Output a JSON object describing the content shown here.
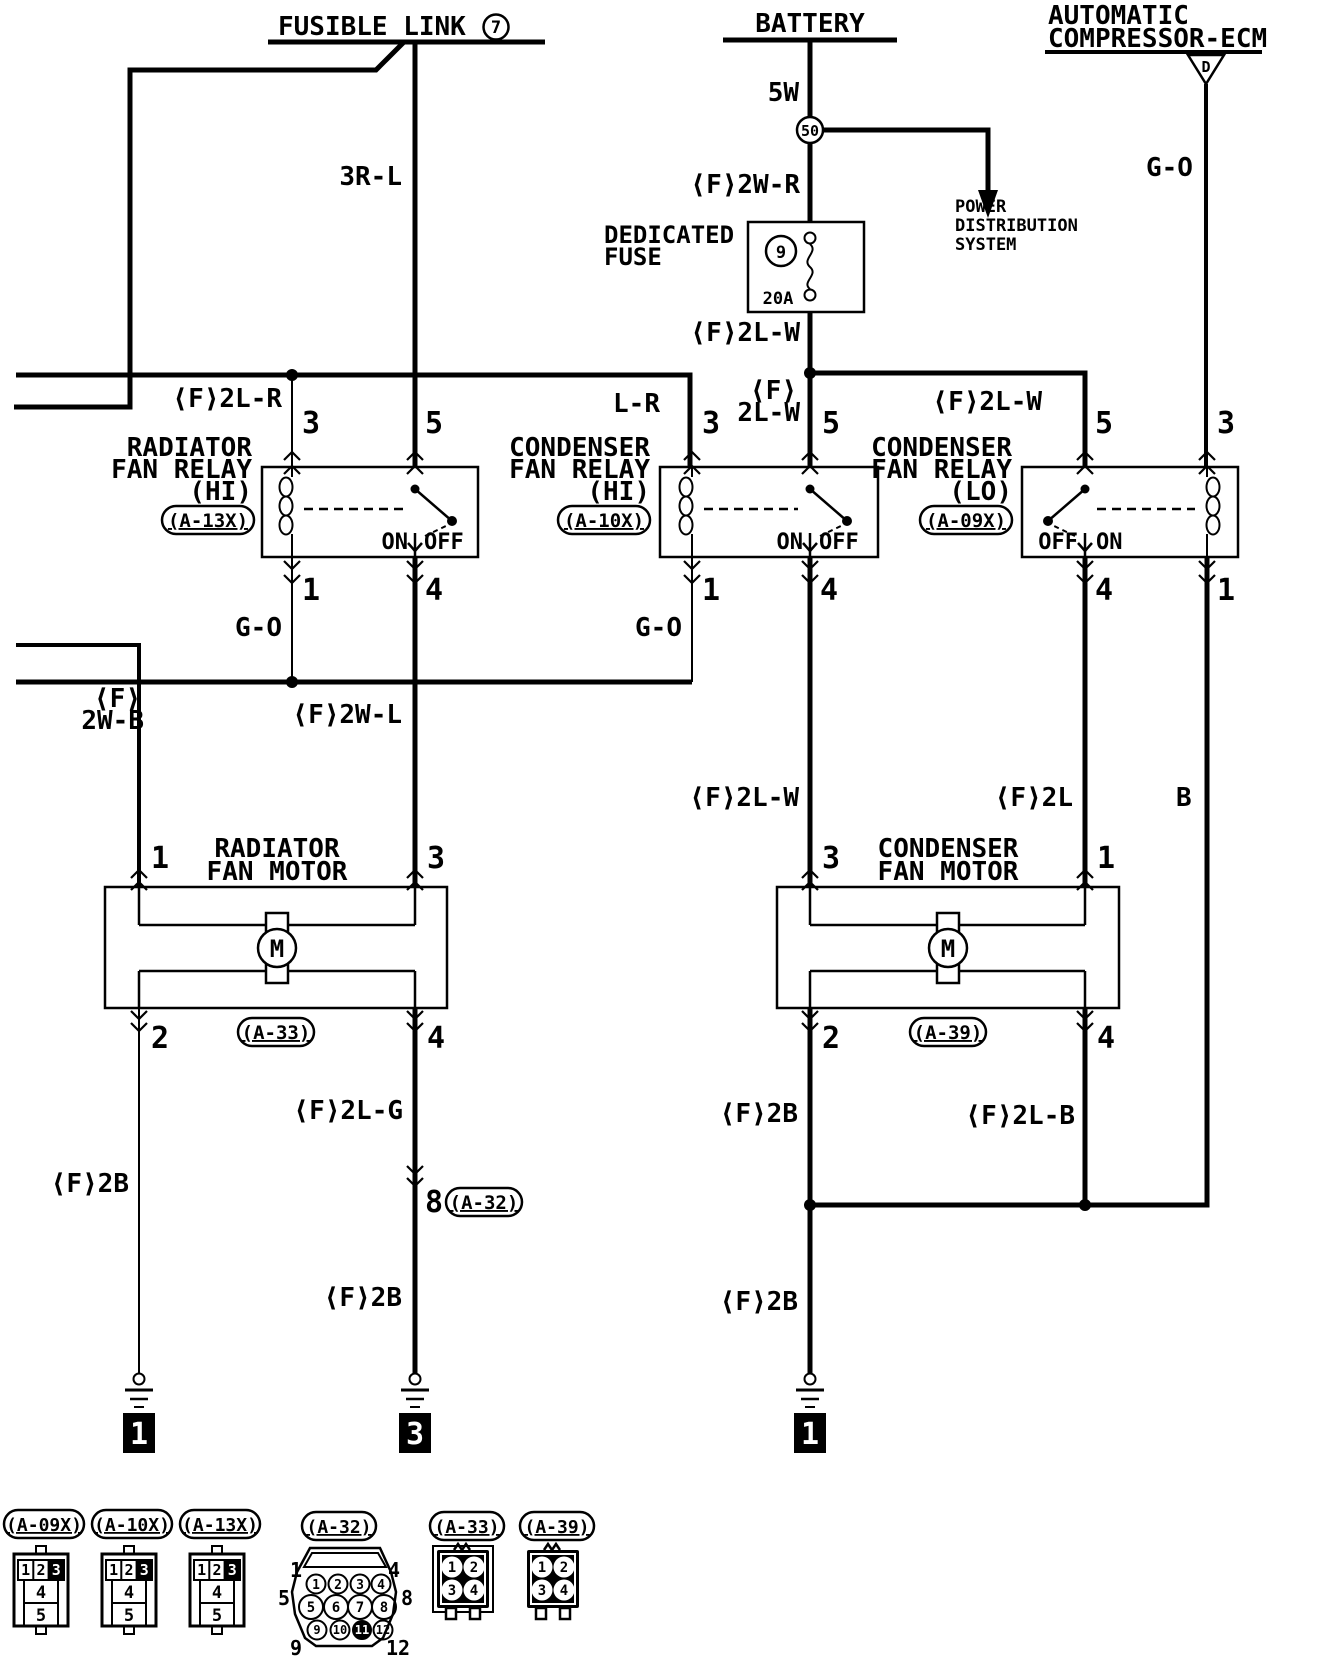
{
  "sources": {
    "fusible_link": {
      "label": "FUSIBLE LINK",
      "number": "7"
    },
    "battery": {
      "label": "BATTERY"
    },
    "ecm": {
      "line1": "AUTOMATIC",
      "line2": "COMPRESSOR-ECM",
      "marker": "D"
    }
  },
  "power_distribution": {
    "line1": "POWER",
    "line2": "DISTRIBUTION",
    "line3": "SYSTEM"
  },
  "fuse": {
    "label_line1": "DEDICATED",
    "label_line2": "FUSE",
    "number": "9",
    "rating": "20A"
  },
  "junctions": {
    "battery_terminal": "50"
  },
  "wires": {
    "w3rl": "3R-L",
    "w5w": "5W",
    "f2wr": "⟨F⟩2W-R",
    "f2lw_fuse": "⟨F⟩2L-W",
    "f2lr": "⟨F⟩2L-R",
    "lr": "L-R",
    "f_stack": "⟨F⟩",
    "lw_stack": "2L-W",
    "f2lw_lo": "⟨F⟩2L-W",
    "go_ecm": "G-O",
    "go_a13x": "G-O",
    "go_a10x": "G-O",
    "f_stack2": "⟨F⟩",
    "wb_stack": "2W-B",
    "f2wl": "⟨F⟩2W-L",
    "f2lw_mid": "⟨F⟩2L-W",
    "f2l": "⟨F⟩2L",
    "b": "B",
    "f2lg": "⟨F⟩2L-G",
    "f2b_left": "⟨F⟩2B",
    "f2b_mid": "⟨F⟩2B",
    "f2b_r1": "⟨F⟩2B",
    "f2lb": "⟨F⟩2L-B",
    "f2b_r2": "⟨F⟩2B"
  },
  "relays": [
    {
      "name1": "RADIATOR",
      "name2": "FAN RELAY",
      "name3": "(HI)",
      "id": "(A-13X)",
      "pin_tl": "3",
      "pin_tr": "5",
      "pin_bl": "1",
      "pin_br": "4",
      "sw_left": "ON",
      "sw_right": "OFF"
    },
    {
      "name1": "CONDENSER",
      "name2": "FAN RELAY",
      "name3": "(HI)",
      "id": "(A-10X)",
      "pin_tl": "3",
      "pin_tr": "5",
      "pin_bl": "1",
      "pin_br": "4",
      "sw_left": "ON",
      "sw_right": "OFF"
    },
    {
      "name1": "CONDENSER",
      "name2": "FAN RELAY",
      "name3": "(LO)",
      "id": "(A-09X)",
      "pin_tl": "5",
      "pin_tr": "3",
      "pin_bl": "4",
      "pin_br": "1",
      "sw_left": "OFF",
      "sw_right": "ON"
    }
  ],
  "motors": [
    {
      "name1": "RADIATOR",
      "name2": "FAN MOTOR",
      "id": "(A-33)",
      "sym": "M",
      "pin_tl": "1",
      "pin_tr": "3",
      "pin_bl": "2",
      "pin_br": "4"
    },
    {
      "name1": "CONDENSER",
      "name2": "FAN MOTOR",
      "id": "(A-39)",
      "sym": "M",
      "pin_tl": "3",
      "pin_tr": "1",
      "pin_bl": "2",
      "pin_br": "4"
    }
  ],
  "inline_connector": {
    "pin": "8",
    "id": "(A-32)"
  },
  "grounds": [
    "1",
    "3",
    "1"
  ],
  "connector_faces": {
    "a09x": {
      "label": "(A-09X)",
      "row": [
        "1",
        "2",
        "3"
      ],
      "mid": "4",
      "bot": "5"
    },
    "a10x": {
      "label": "(A-10X)",
      "row": [
        "1",
        "2",
        "3"
      ],
      "mid": "4",
      "bot": "5"
    },
    "a13x": {
      "label": "(A-13X)",
      "row": [
        "1",
        "2",
        "3"
      ],
      "mid": "4",
      "bot": "5"
    },
    "a32": {
      "label": "(A-32)",
      "pins": [
        "1",
        "2",
        "3",
        "4",
        "5",
        "6",
        "7",
        "8",
        "9",
        "10",
        "11",
        "12"
      ],
      "corner_tl": "1",
      "corner_tr": "4",
      "corner_ml": "5",
      "corner_mr": "8",
      "corner_bl": "9",
      "corner_br": "12"
    },
    "a33": {
      "label": "(A-33)",
      "pins": [
        "1",
        "2",
        "3",
        "4"
      ]
    },
    "a39": {
      "label": "(A-39)",
      "pins": [
        "1",
        "2",
        "3",
        "4"
      ]
    }
  }
}
